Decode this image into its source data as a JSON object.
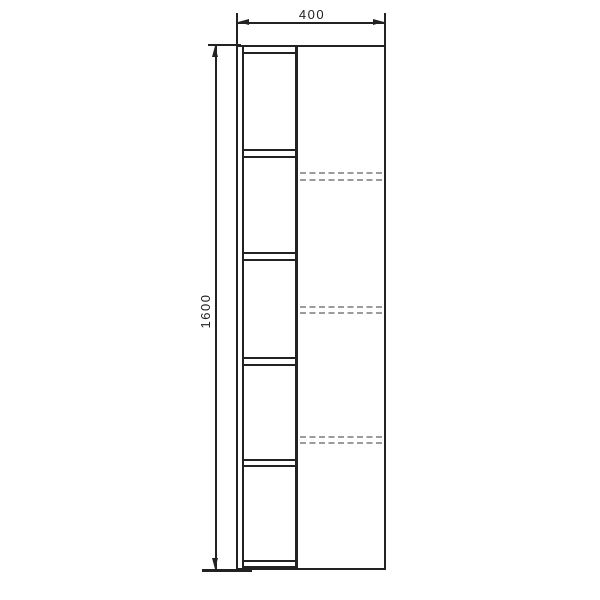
{
  "page": {
    "background_color": "#ffffff",
    "content": "technical elevation drawing of a tall cabinet"
  },
  "drawing": {
    "type": "furniture-elevation",
    "line_color": "#222222",
    "hidden_line_color": "#9b9b9b",
    "dimensions": {
      "width": {
        "label": "400"
      },
      "height": {
        "label": "1600"
      }
    },
    "structure": {
      "open_shelf_compartments": 5,
      "shelf_double_lines": 5,
      "hidden_shelf_dashed_rows": 3,
      "sections": [
        "open shelf column (left)",
        "door panel with hidden shelves (right)"
      ]
    }
  }
}
